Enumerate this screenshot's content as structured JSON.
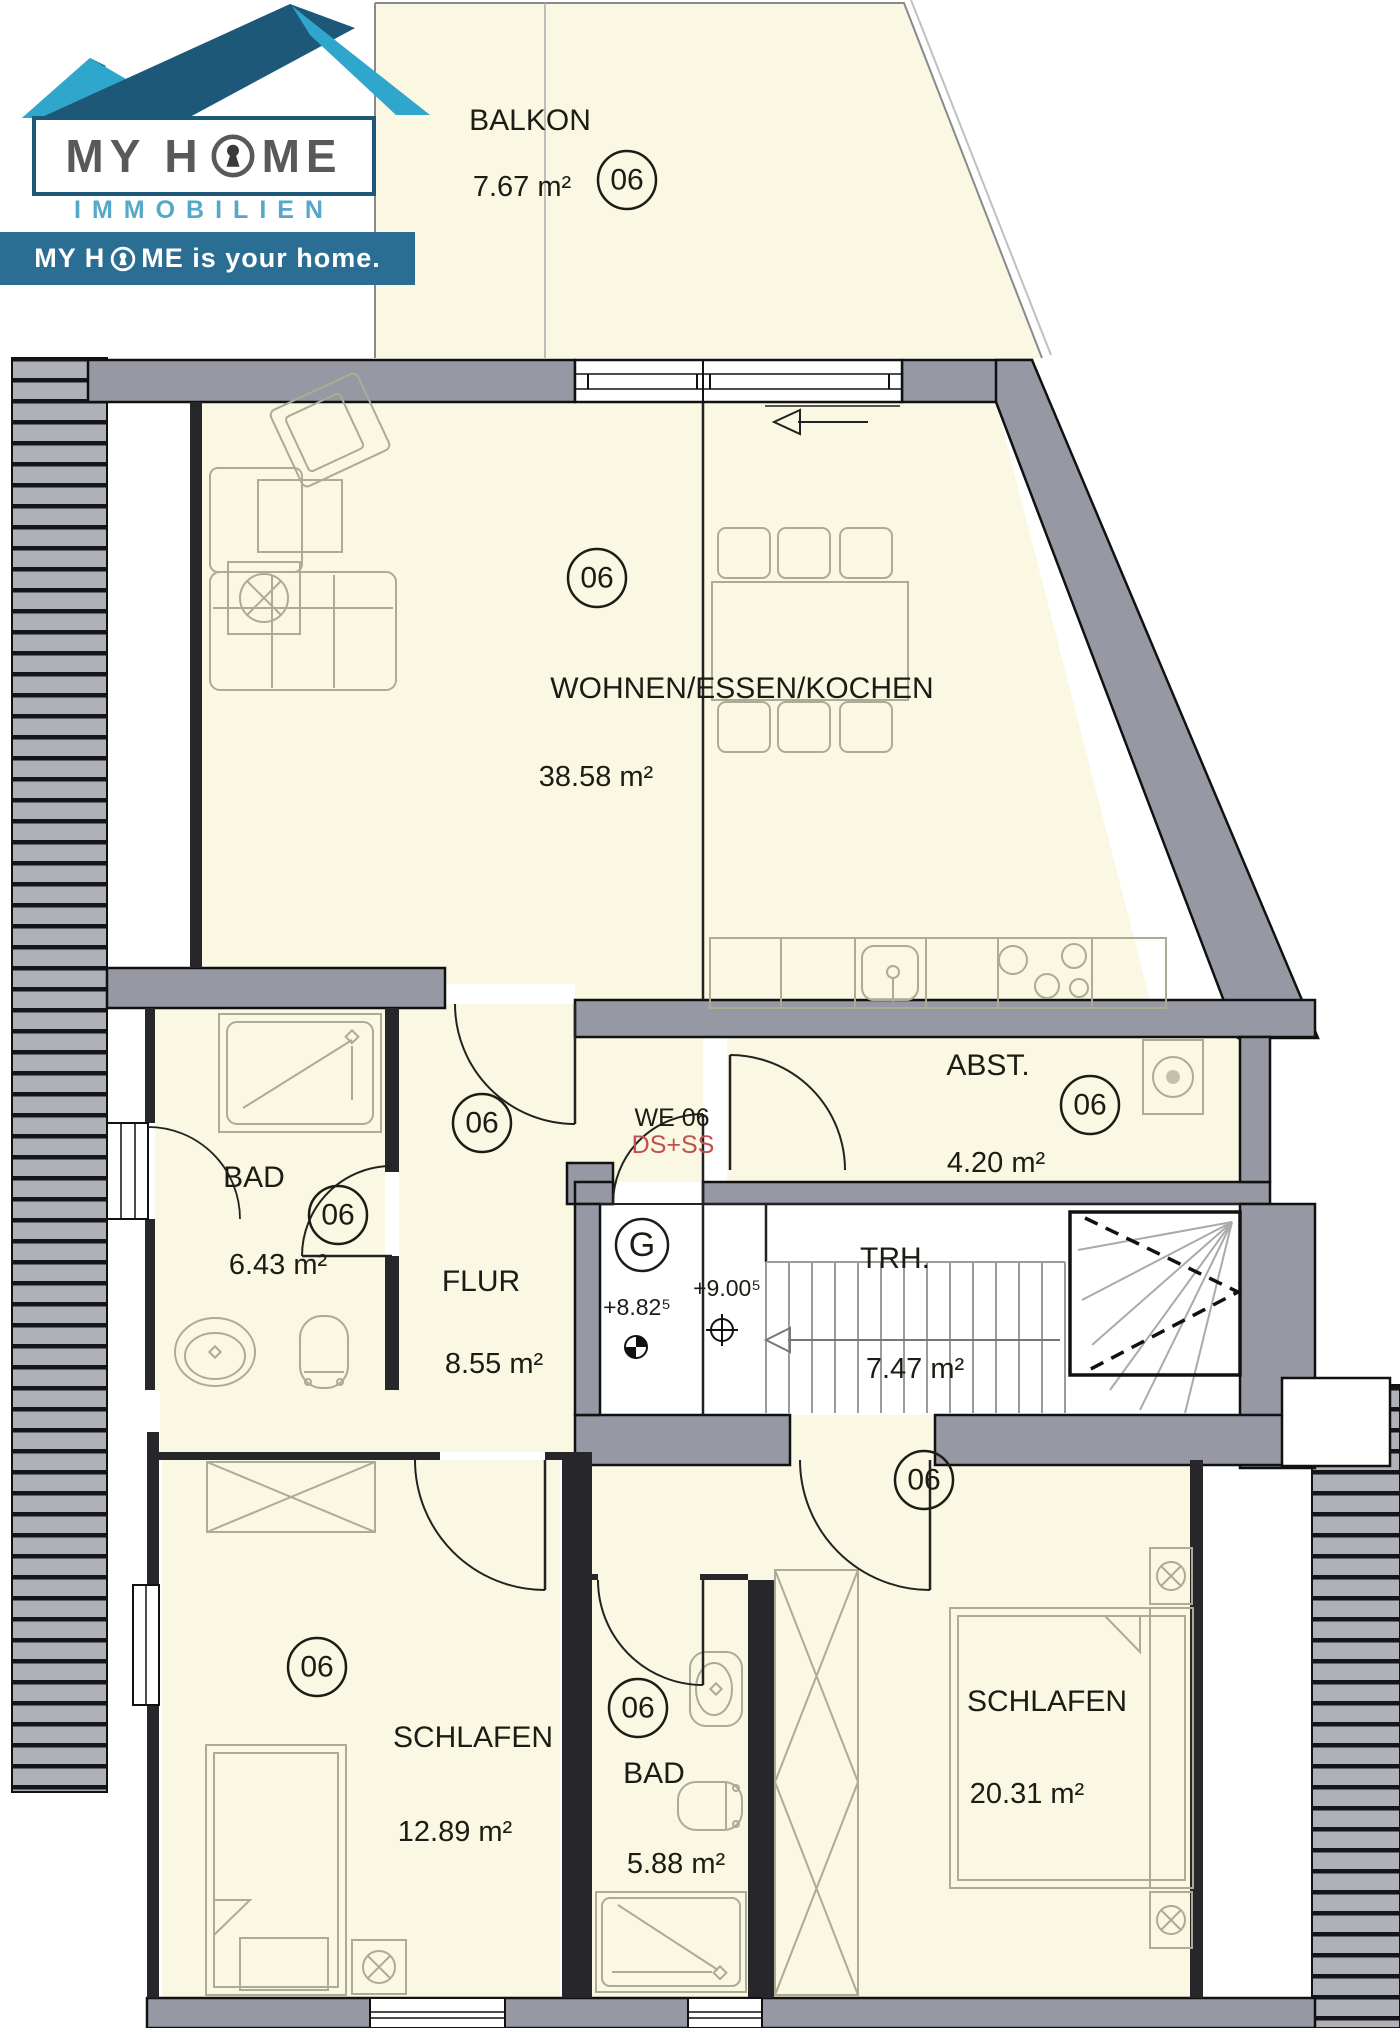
{
  "logo": {
    "brand_left": "MY H",
    "brand_right": "ME",
    "division": "IMMOBILIEN",
    "tagline_left": "MY H",
    "tagline_right": "ME is your home."
  },
  "unit_label": {
    "we": "WE 06",
    "systems": "DS+SS"
  },
  "level_markers": {
    "ground": "G",
    "inner": "+8.82⁵",
    "landing": "+9.00⁵"
  },
  "rooms": [
    {
      "name": "BALKON",
      "area": "7.67 m²",
      "unit": "06"
    },
    {
      "name": "WOHNEN/ESSEN/KOCHEN",
      "area": "38.58 m²",
      "unit": "06"
    },
    {
      "name": "BAD",
      "area": "6.43 m²",
      "unit": "06"
    },
    {
      "name": "FLUR",
      "area": "8.55 m²",
      "unit": "06"
    },
    {
      "name": "ABST.",
      "area": "4.20 m²",
      "unit": "06"
    },
    {
      "name": "TRH.",
      "area": "7.47 m²"
    },
    {
      "name": "SCHLAFEN",
      "area": "12.89 m²",
      "unit": "06"
    },
    {
      "name": "BAD",
      "area": "5.88 m²",
      "unit": "06"
    },
    {
      "name": "SCHLAFEN",
      "area": "20.31 m²",
      "unit": "06"
    }
  ],
  "colors": {
    "room_fill": "#FAF7E2",
    "wall_fill": "#9699A4",
    "hatch_fill": "#AFB1B9",
    "accent_dark_blue": "#1E5878",
    "accent_light_blue": "#2FA6CB",
    "banner_blue": "#2B6E93",
    "logo_text_gray": "#58595B",
    "label_red": "#C0504D"
  }
}
